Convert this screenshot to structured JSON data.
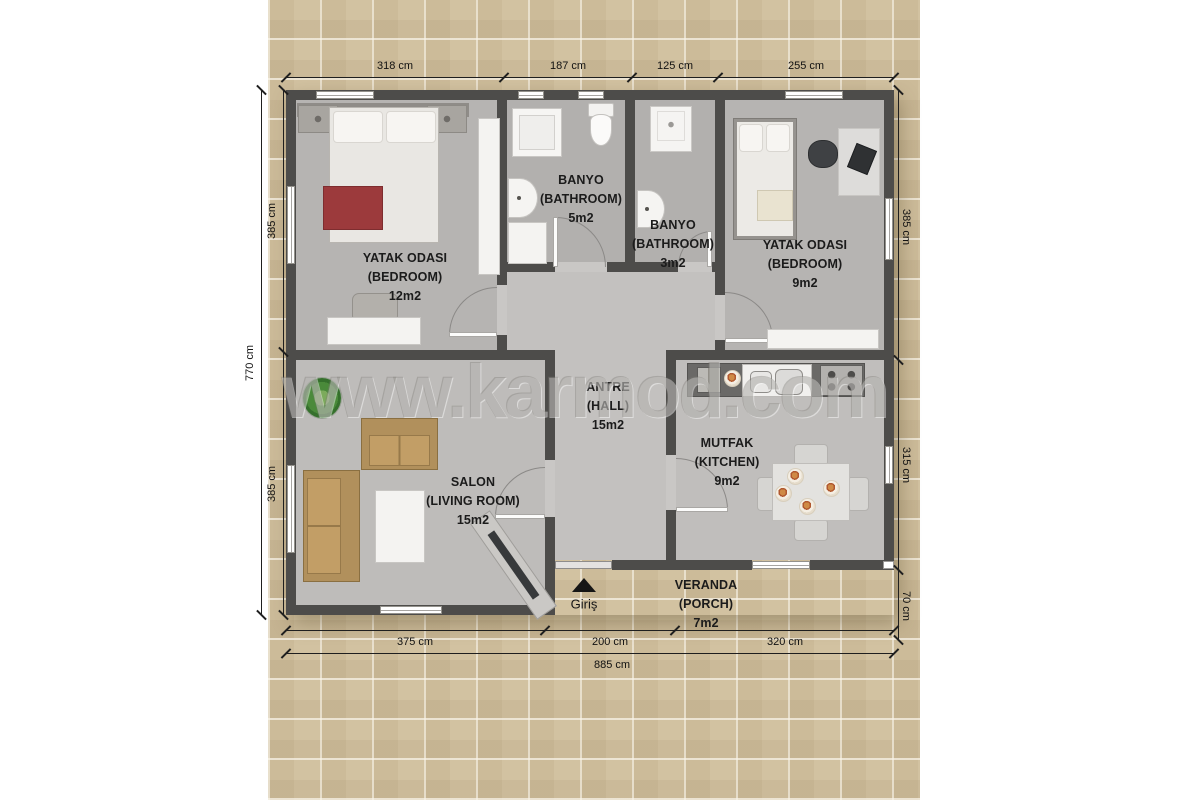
{
  "watermark": "www.karmod.com",
  "entrance": {
    "label": "Giriş"
  },
  "rooms": {
    "bedroom1": {
      "line1": "YATAK ODASI",
      "line2": "(BEDROOM)",
      "area": "12m2"
    },
    "bathroom1": {
      "line1": "BANYO",
      "line2": "(BATHROOM)",
      "area": "5m2"
    },
    "bathroom2": {
      "line1": "BANYO",
      "line2": "(BATHROOM)",
      "area": "3m2"
    },
    "bedroom2": {
      "line1": "YATAK ODASI",
      "line2": "(BEDROOM)",
      "area": "9m2"
    },
    "living": {
      "line1": "SALON",
      "line2": "(LIVING ROOM)",
      "area": "15m2"
    },
    "hall": {
      "line1": "ANTRE",
      "line2": "(HALL)",
      "area": "15m2"
    },
    "kitchen": {
      "line1": "MUTFAK",
      "line2": "(KITCHEN)",
      "area": "9m2"
    },
    "porch": {
      "line1": "VERANDA",
      "line2": "(PORCH)",
      "area": "7m2"
    }
  },
  "dimensions": {
    "top": [
      "318 cm",
      "187 cm",
      "125 cm",
      "255 cm"
    ],
    "left_inner": [
      "385 cm",
      "385 cm"
    ],
    "left_outer": "770 cm",
    "right": [
      "385 cm",
      "315 cm",
      "70 cm"
    ],
    "bottom_inner": [
      "375 cm",
      "200 cm",
      "320 cm"
    ],
    "bottom_outer": "885 cm"
  },
  "colors": {
    "wall": "#4d4c4a",
    "floor": "#bbb9b7",
    "stone_background": "#d2c2a1",
    "accent_red": "#9c3a3c",
    "sofa_tan": "#b1905c",
    "dimension_text": "#111111"
  }
}
